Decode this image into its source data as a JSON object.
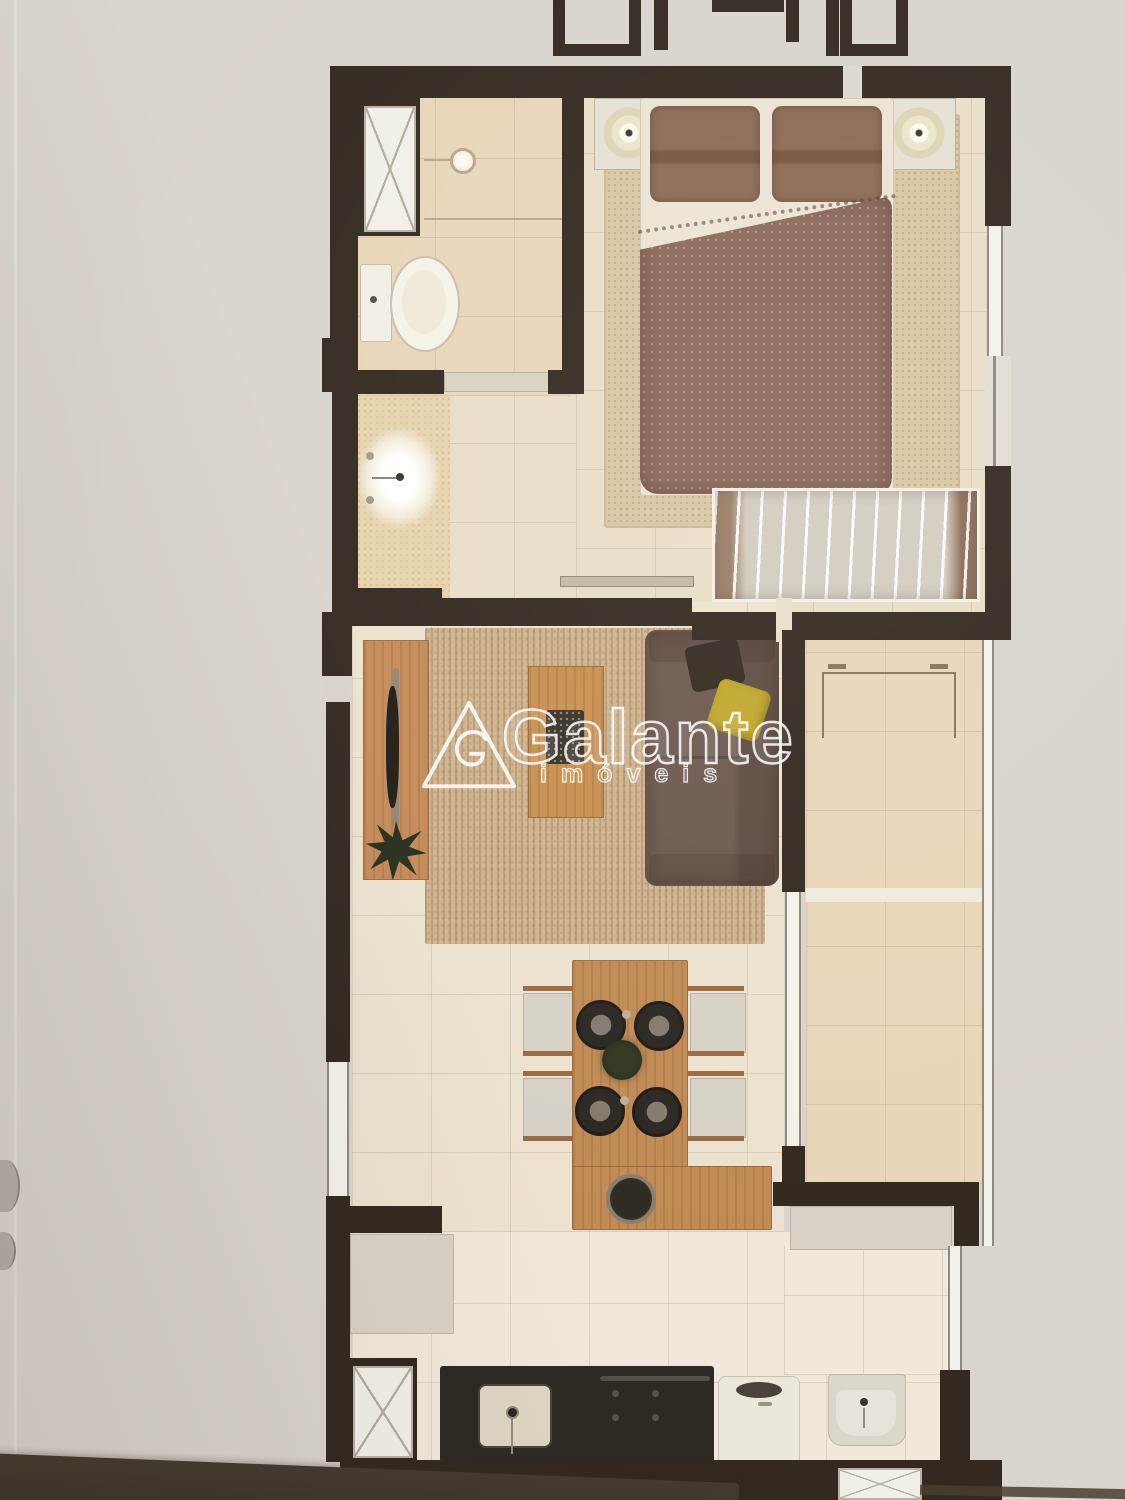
{
  "watermark": {
    "brand": "Galante",
    "sub": "imóveis"
  },
  "palette": {
    "paper": "#d9d4cc",
    "wall": "#33291f",
    "grout": "rgba(151,123,88,0.20)",
    "tileWarm": "#e9dec7",
    "tileBath": "#e8d6b8",
    "tileLight": "#f0e9db",
    "tileLive": "#ece2cf",
    "rugWood": "#cdb28c",
    "rugBed": "#d9c7a2",
    "wood": "#c18b54",
    "console": "#c58a58",
    "sofa": "#6d594f",
    "sofaDark": "#5e4c42",
    "pillowDark": "#342a20",
    "pillowYellow": "#c0a72c",
    "duvet": "#8a695a",
    "bedPillow": "#8c6a55",
    "sheet": "#ebe4d3",
    "white": "#f2efe7",
    "gray": "#d8d2c6",
    "counterDark": "#2e2923",
    "appliance": "#ece7db",
    "metal": "#8f897c",
    "plant": "#27301d",
    "outline": "#8a7358",
    "watermark": "rgba(255,255,255,0.85)",
    "band": "#3a3027"
  }
}
